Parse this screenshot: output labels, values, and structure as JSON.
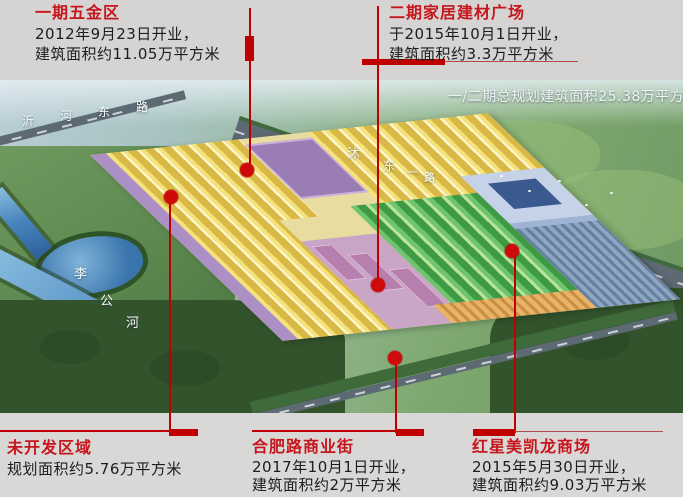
{
  "accent": {
    "title_red": "#c5161d",
    "line_red": "#c00000",
    "dot_red": "#cf0a0a"
  },
  "callouts": {
    "phase1_hardware": {
      "title": "一期五金区",
      "line1": "2012年9月23日开业，",
      "line2": "建筑面积约11.05万平方米"
    },
    "phase2_building_materials": {
      "title": "二期家居建材广场",
      "line1": "于2015年10月1日开业，",
      "line2": "建筑面积约3.3万平方米"
    },
    "total_planned": {
      "label": "一/二期总规划建筑面积25.38万平方米"
    },
    "undeveloped": {
      "title": "未开发区域",
      "line1": "规划面积约5.76万平方米"
    },
    "hefei_road_street": {
      "title": "合肥路商业街",
      "line1": "2017年10月1日开业，",
      "line2": "建筑面积约2万平方米"
    },
    "macalline_mall": {
      "title": "红星美凯龙商场",
      "line1": "2015年5月30日开业，",
      "line2": "建筑面积约9.03万平方米"
    }
  },
  "map_labels": {
    "road_yihedong": [
      "沂",
      "河",
      "东",
      "路"
    ],
    "road_shudong": [
      "沭",
      "东",
      "一",
      "路"
    ],
    "river": [
      "李",
      "公",
      "河"
    ]
  },
  "zones": [
    {
      "name": "phase1-hardware-warehouses",
      "color": "#f5e27a"
    },
    {
      "name": "phase2-green-roof-market",
      "color": "#6fc46f"
    },
    {
      "name": "macalline-mall-blue",
      "color": "#c5d2e8"
    },
    {
      "name": "hefei-road-street-orange",
      "color": "#e8b268"
    },
    {
      "name": "residential-pink",
      "color": "#b77fae"
    },
    {
      "name": "undeveloped-purple",
      "color": "#ab8fc5"
    }
  ]
}
